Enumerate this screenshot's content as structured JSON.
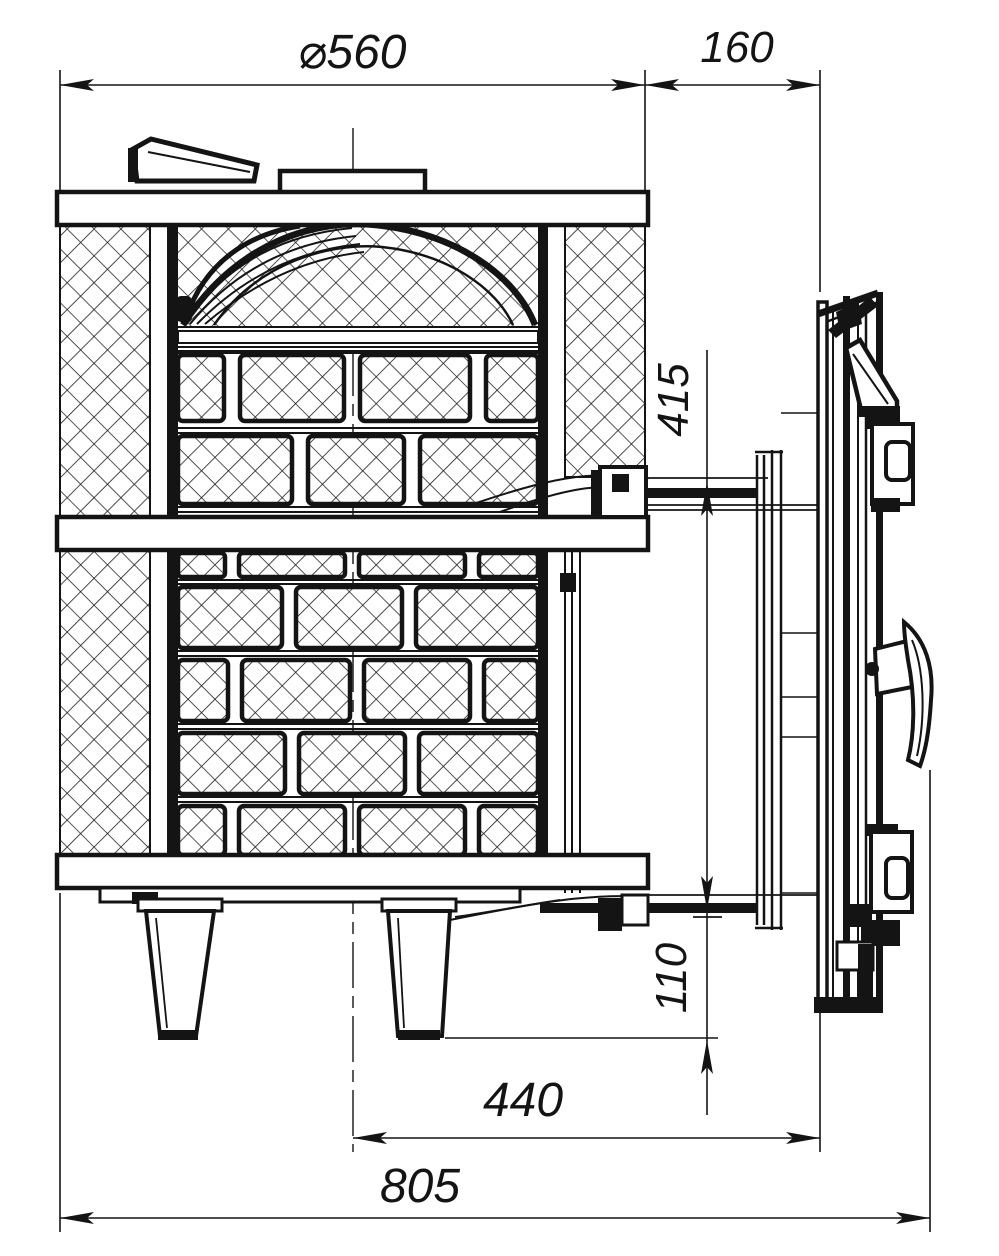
{
  "drawing": {
    "title": "Stove cross-section technical drawing",
    "colors": {
      "ink": "#141414",
      "paper": "#ffffff"
    },
    "dimensions": {
      "top_diameter": "⌀560",
      "door_tunnel_length": "160",
      "door_opening_height": "415",
      "bottom_clearance": "110",
      "axis_to_door_front": "440",
      "overall_depth": "805"
    }
  }
}
